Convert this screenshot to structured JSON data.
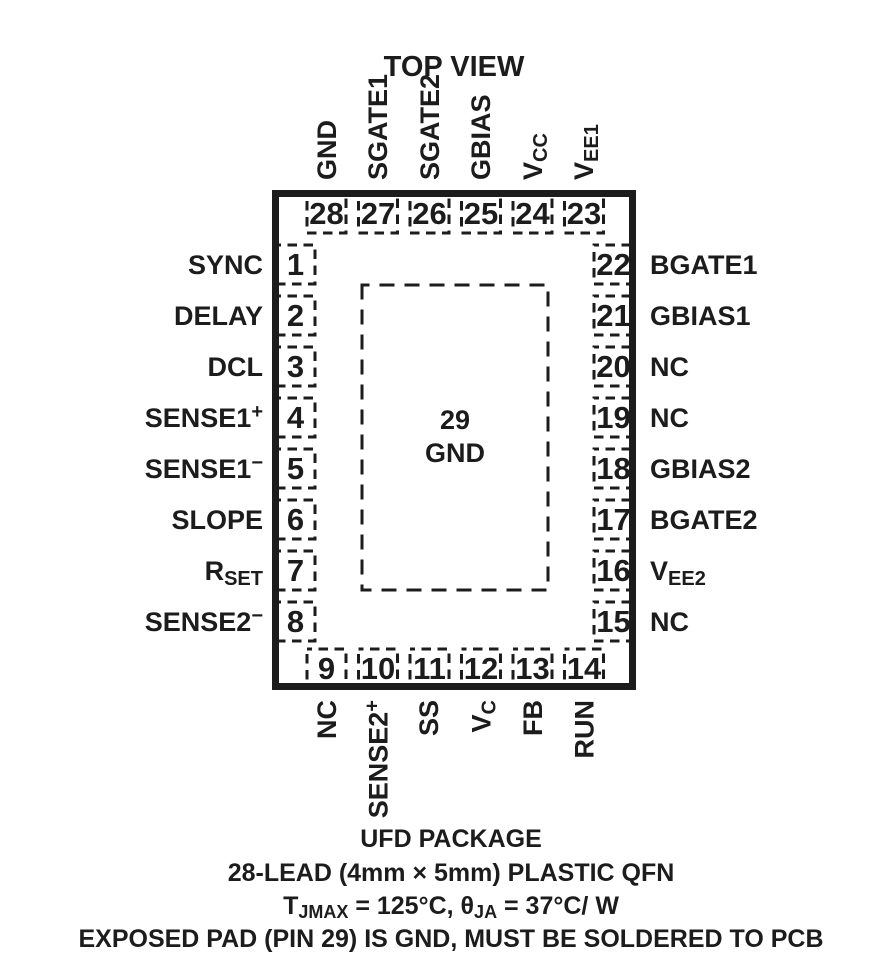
{
  "title": "TOP VIEW",
  "colors": {
    "ink": "#1c1c1c",
    "background": "#ffffff"
  },
  "package": {
    "center_pin": {
      "num": "29",
      "label": "GND"
    }
  },
  "pins": {
    "top": [
      {
        "num": "28",
        "label": "GND"
      },
      {
        "num": "27",
        "label": "SGATE1"
      },
      {
        "num": "26",
        "label": "SGATE2"
      },
      {
        "num": "25",
        "label": "GBIAS"
      },
      {
        "num": "24",
        "label": "V",
        "sub": "CC"
      },
      {
        "num": "23",
        "label": "V",
        "sub": "EE1"
      }
    ],
    "left": [
      {
        "num": "1",
        "label": "SYNC"
      },
      {
        "num": "2",
        "label": "DELAY"
      },
      {
        "num": "3",
        "label": "DCL"
      },
      {
        "num": "4",
        "label": "SENSE1",
        "sup": "+"
      },
      {
        "num": "5",
        "label": "SENSE1",
        "sup": "−"
      },
      {
        "num": "6",
        "label": "SLOPE"
      },
      {
        "num": "7",
        "label": "R",
        "sub": "SET"
      },
      {
        "num": "8",
        "label": "SENSE2",
        "sup": "−"
      }
    ],
    "right": [
      {
        "num": "22",
        "label": "BGATE1"
      },
      {
        "num": "21",
        "label": "GBIAS1"
      },
      {
        "num": "20",
        "label": "NC"
      },
      {
        "num": "19",
        "label": "NC"
      },
      {
        "num": "18",
        "label": "GBIAS2"
      },
      {
        "num": "17",
        "label": "BGATE2"
      },
      {
        "num": "16",
        "label": "V",
        "sub": "EE2"
      },
      {
        "num": "15",
        "label": "NC"
      }
    ],
    "bottom": [
      {
        "num": "9",
        "label": "NC"
      },
      {
        "num": "10",
        "label": "SENSE2",
        "sup": "+"
      },
      {
        "num": "11",
        "label": "SS"
      },
      {
        "num": "12",
        "label": "V",
        "sub": "C"
      },
      {
        "num": "13",
        "label": "FB"
      },
      {
        "num": "14",
        "label": "RUN"
      }
    ]
  },
  "footer": {
    "line1": "UFD PACKAGE",
    "line2": "28-LEAD (4mm × 5mm) PLASTIC QFN",
    "line3": {
      "t1": "T",
      "s1": "JMAX",
      "t2": " = 125°C, θ",
      "s2": "JA",
      "t3": " = 37°C/ W"
    },
    "line4": "EXPOSED PAD (PIN 29) IS GND, MUST BE SOLDERED TO PCB"
  }
}
